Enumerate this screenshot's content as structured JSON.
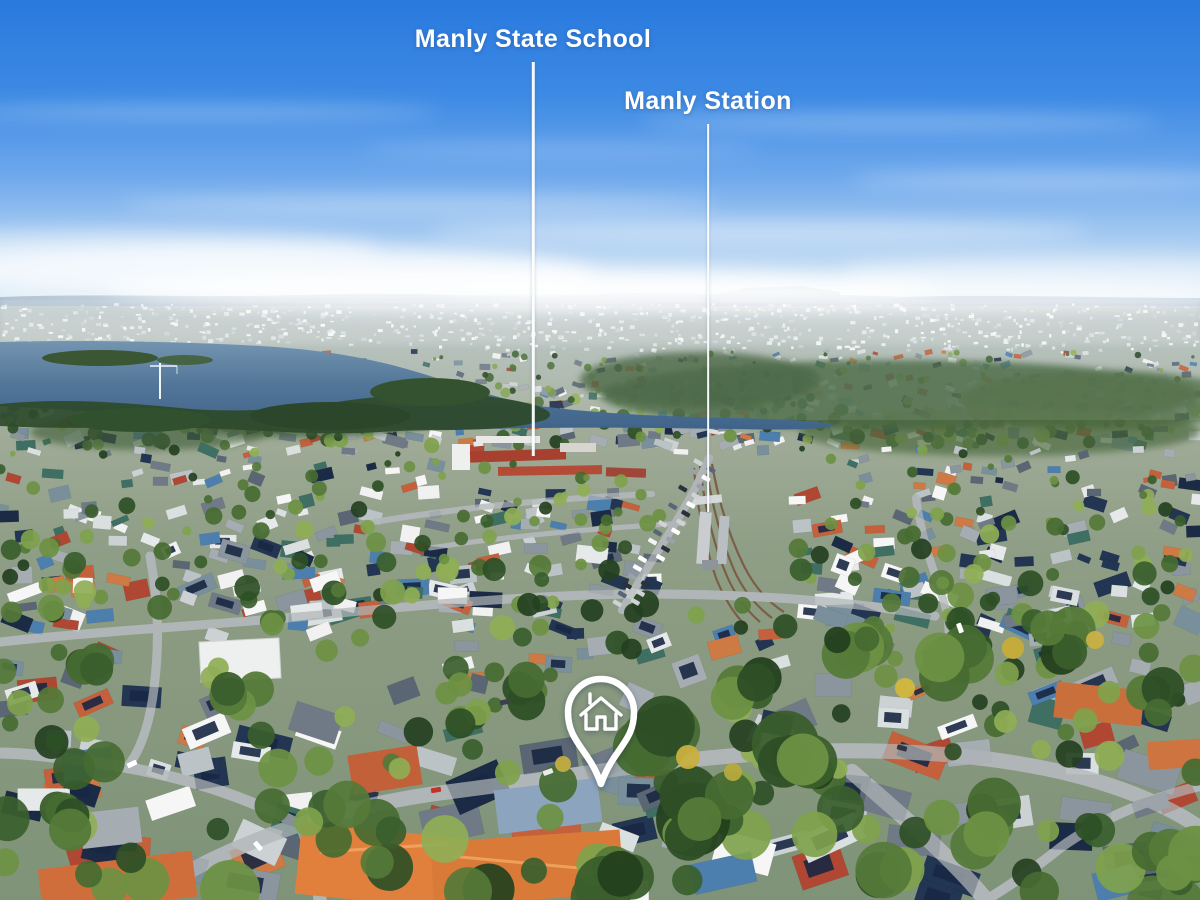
{
  "scene": {
    "type": "aerial-drone-photograph",
    "sky_color": "#2b7de0",
    "water_color": "#4a6f93",
    "overlay_color": "#ffffff"
  },
  "callouts": [
    {
      "label": "Manly State School"
    },
    {
      "label": "Manly Station"
    }
  ],
  "marker": {
    "type": "location-pin",
    "icon": "house-outline"
  }
}
